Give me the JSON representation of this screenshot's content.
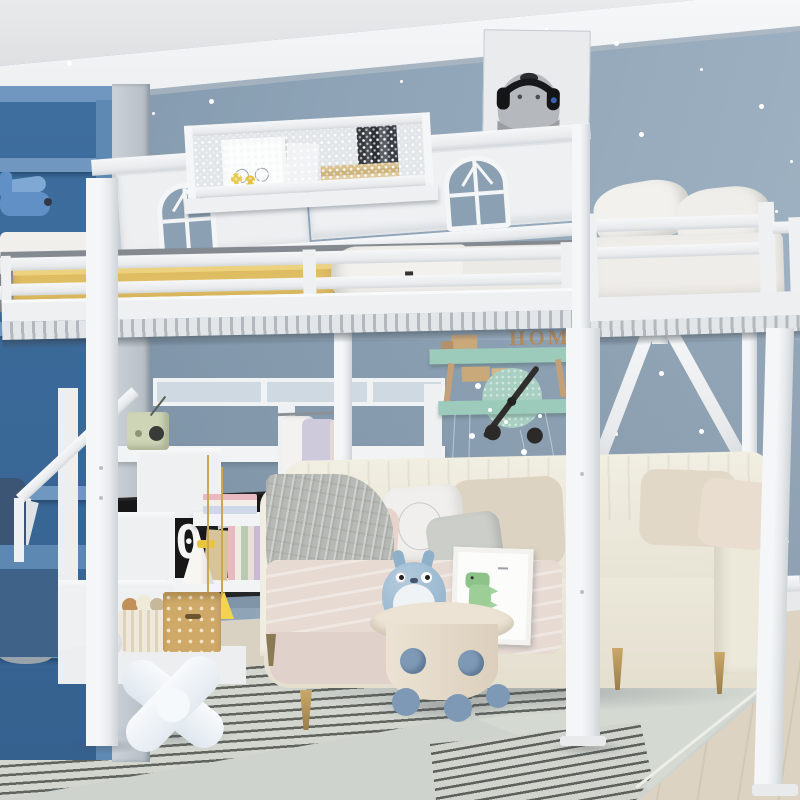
{
  "clock": {
    "hours": "10",
    "minutes": "39"
  },
  "wall_sign": {
    "text": "HOME"
  },
  "palette": {
    "wall": "#8FA3B6",
    "ceiling": "#E7E8E9",
    "molding": "#F3F4F5",
    "bed_frame_white": "#F2F3F5",
    "mattress_yellow": "#DFBD62",
    "bedding_white": "#F1F0EE",
    "bookshelf_blue": "#4A78A6",
    "desk_blue": "#5D88B1",
    "couch_ivory": "#EDEADE",
    "throw_gray": "#B5B7B2",
    "rug_gray": "#CED3CD",
    "rug_beige": "#D9D2C3",
    "rug_stripe_dark": "#60645F",
    "floor_wood": "#DCD3C3",
    "shelf_mint": "#9CCABB",
    "sign_letters_wood": "#B08A5E",
    "table_cream": "#EAE1D2",
    "accent_blue": "#7E99B5",
    "tassel_yellow": "#F2CE41",
    "totoro_blue": "#9DB9CF",
    "dino_green": "#8CC389",
    "radio_sage": "#CED4B6",
    "clock_screen": "#161616",
    "clock_digits": "#F2F2F2"
  }
}
